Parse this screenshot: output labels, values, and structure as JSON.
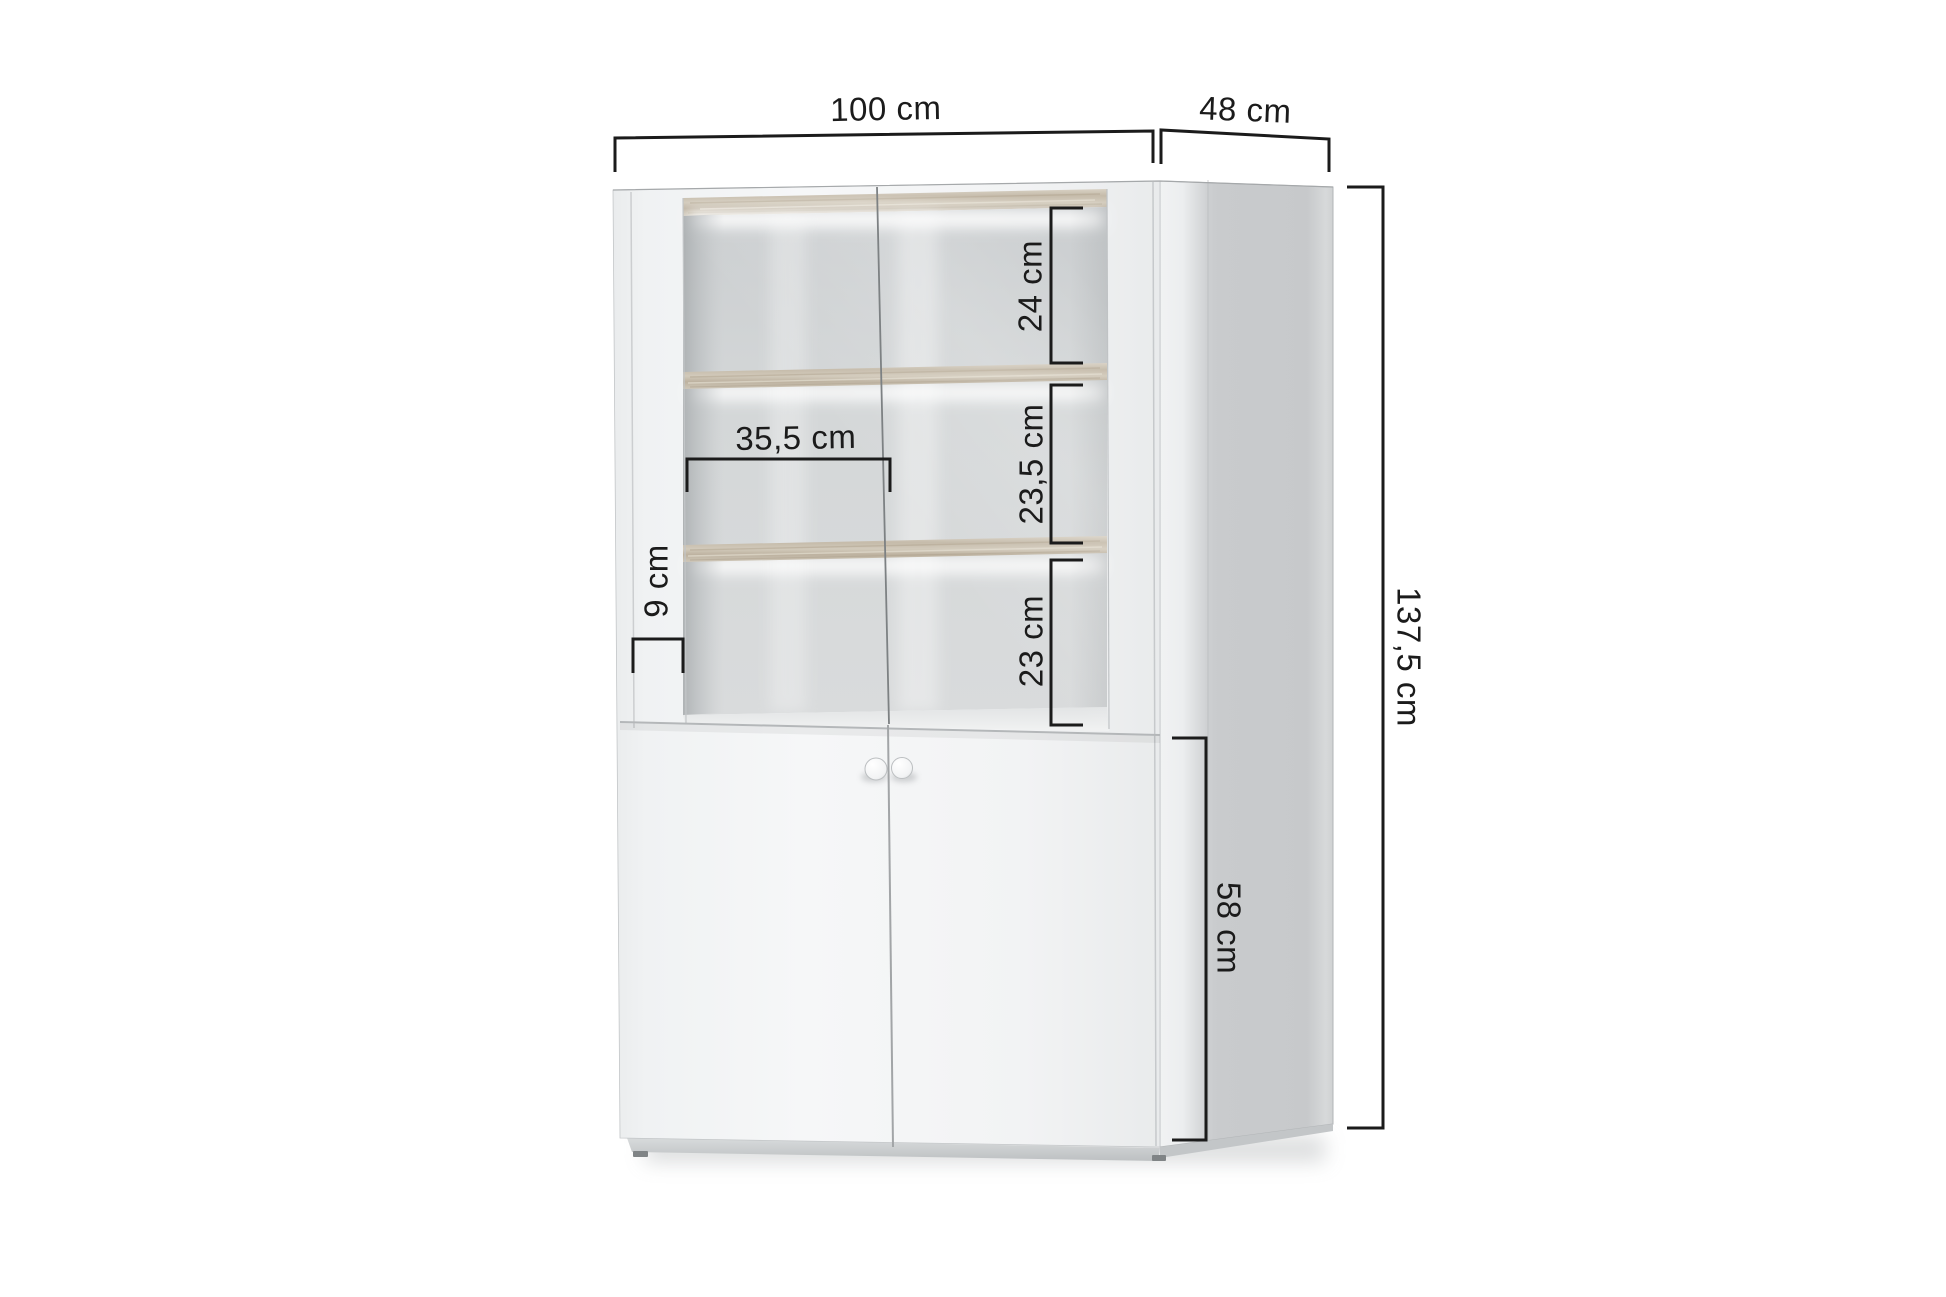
{
  "diagram": {
    "unit": "cm",
    "labels": {
      "width": "100 cm",
      "depth": "48 cm",
      "height": "137,5 cm",
      "compartment_top": "24 cm",
      "compartment_middle": "23,5 cm",
      "compartment_bottom": "23 cm",
      "inner_width": "35,5 cm",
      "frame_width": "9 cm",
      "base_section_height": "58 cm"
    },
    "dimensions_cm": {
      "width": 100,
      "depth": 48,
      "height": 137.5,
      "compartment_top": 24,
      "compartment_middle": 23.5,
      "compartment_bottom": 23,
      "inner_width": 35.5,
      "frame_width": 9,
      "base_section_height": 58
    },
    "colors": {
      "dimension_line": "#1b1b1b",
      "label_text": "#1b1b1b",
      "background": "#ffffff",
      "cabinet_front": "#f3f4f5",
      "side_panel": "#c9cbcd",
      "interior_back_wall": "#d3d6d8",
      "shelf_wood": "#cbc2b1",
      "led_glow": "#ffffff"
    }
  }
}
